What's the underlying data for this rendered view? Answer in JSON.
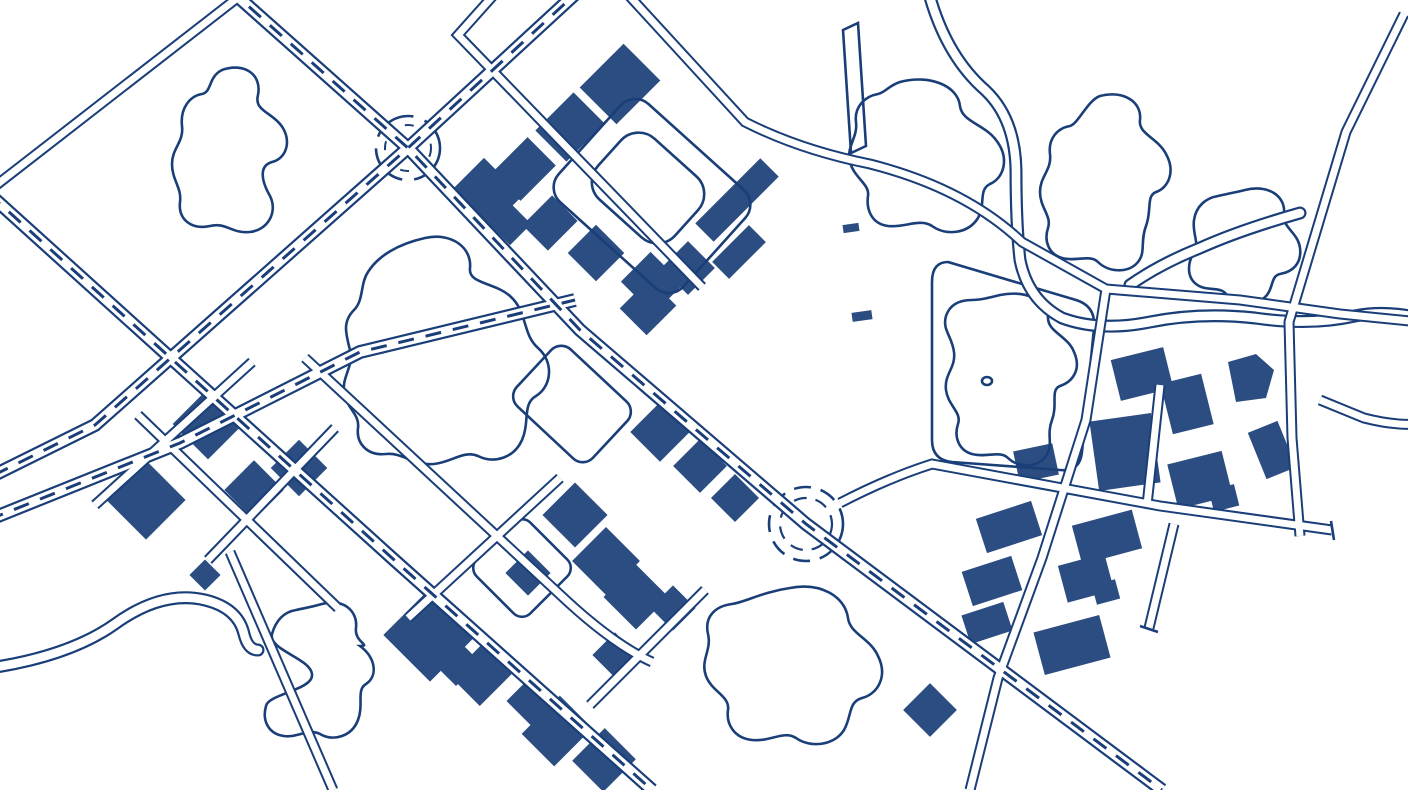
{
  "map": {
    "colors": {
      "background": "#ffffff",
      "line": "#1a3e78",
      "building": "#2b4d81",
      "road_surface": "#ffffff",
      "water_surface": "#ffffff"
    },
    "roundabouts": 2,
    "features": [
      "road-network",
      "dashed-avenue-centerlines",
      "roundabouts",
      "building-footprints",
      "ponds",
      "river",
      "stream",
      "park-with-pond-and-island",
      "sports-field",
      "pier",
      "dead-end-roads"
    ]
  }
}
